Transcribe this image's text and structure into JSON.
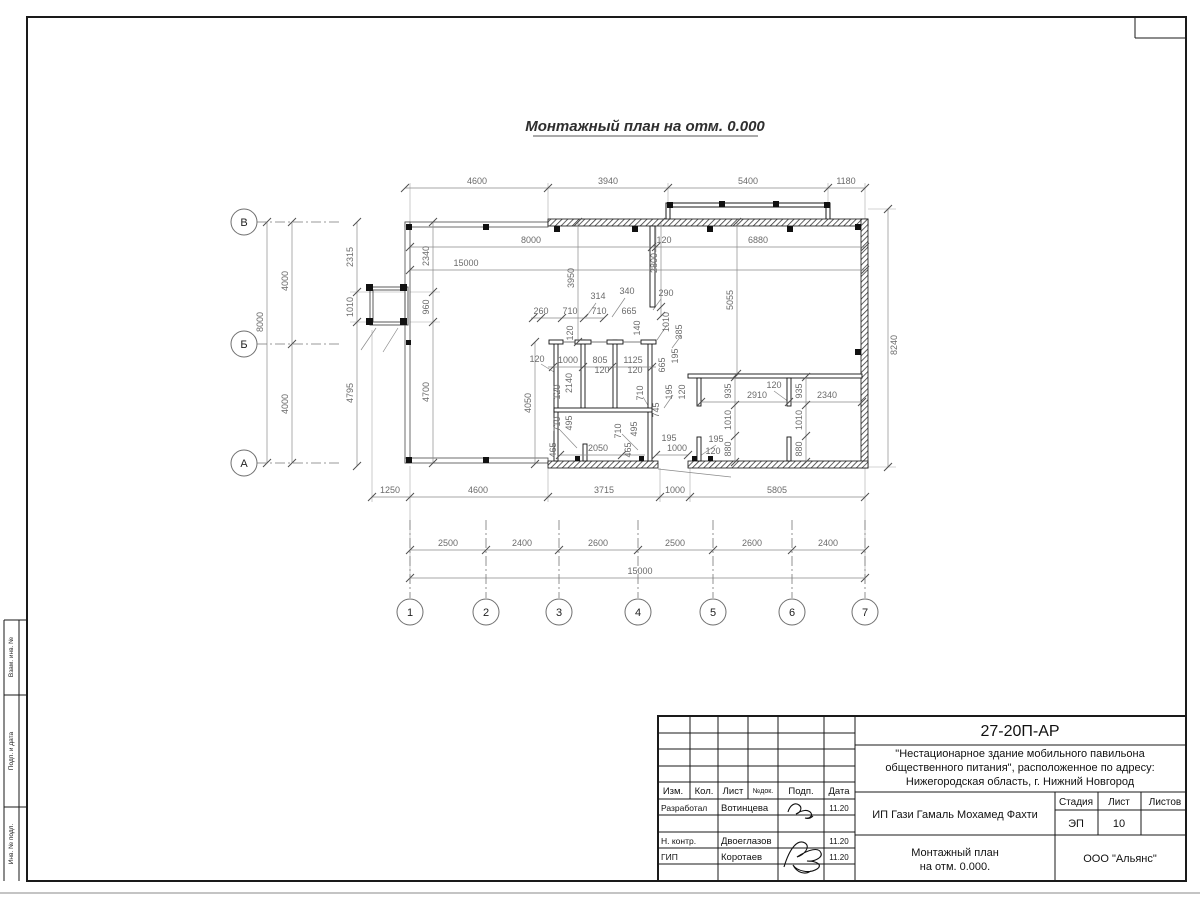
{
  "sheet": {
    "title": "Монтажный план на отм. 0.000"
  },
  "sidebar": {
    "vzam": "Взам. инв. №",
    "podp": "Подп. и дата",
    "inv": "Инв. № подл."
  },
  "titleblock": {
    "code": "27-20П-АР",
    "project_line1": "\"Нестационарное здание мобильного павильона",
    "project_line2": "общественного питания\", расположенное по адресу:",
    "project_line3": "Нижегородская область, г. Нижний Новгород",
    "client": "ИП Гази Гамаль Мохамед Фахти",
    "stage_label": "Стадия",
    "sheet_label": "Лист",
    "sheets_label": "Листов",
    "stage": "ЭП",
    "sheet_no": "10",
    "sheets_no": "",
    "doc_line1": "Монтажный план",
    "doc_line2": "на отм. 0.000.",
    "org": "ООО \"Альянс\"",
    "cols": {
      "izm": "Изм.",
      "kol": "Кол.",
      "list": "Лист",
      "ndok": "№док.",
      "podp": "Подп.",
      "data": "Дата"
    },
    "rows": [
      {
        "role": "Разработал",
        "name": "Вотинцева",
        "date": "11.20"
      },
      {
        "role": "Н. контр.",
        "name": "Двоеглазов",
        "date": "11.20"
      },
      {
        "role": "ГИП",
        "name": "Коротаев",
        "date": "11.20"
      }
    ]
  },
  "plan": {
    "axes": {
      "rows": [
        {
          "label": "В",
          "y": 222
        },
        {
          "label": "Б",
          "y": 344
        },
        {
          "label": "А",
          "y": 463
        }
      ],
      "cols": [
        {
          "label": "1",
          "x": 410
        },
        {
          "label": "2",
          "x": 486
        },
        {
          "label": "3",
          "x": 559
        },
        {
          "label": "4",
          "x": 638
        },
        {
          "label": "5",
          "x": 713
        },
        {
          "label": "6",
          "x": 792
        },
        {
          "label": "7",
          "x": 865
        }
      ]
    },
    "h_chains": [
      {
        "y": 188,
        "x1": 405,
        "x2": 865,
        "ticks": [
          405,
          548,
          668,
          828,
          865
        ],
        "labels": [
          {
            "t": "4600",
            "x": 477
          },
          {
            "t": "3940",
            "x": 608
          },
          {
            "t": "5400",
            "x": 748
          },
          {
            "t": "1180",
            "x": 846
          }
        ]
      },
      {
        "y": 247,
        "x1": 410,
        "x2": 865,
        "ticks": [
          410,
          652,
          656,
          865
        ],
        "labels": [
          {
            "t": "8000",
            "x": 531
          },
          {
            "t": "120",
            "x": 664
          },
          {
            "t": "6880",
            "x": 758
          }
        ]
      },
      {
        "y": 270,
        "x1": 410,
        "x2": 865,
        "ticks": [
          410,
          865
        ],
        "labels": [
          {
            "t": "15000",
            "x": 466
          }
        ]
      },
      {
        "y": 318,
        "x1": 531,
        "x2": 604,
        "ticks": [
          533,
          541,
          562,
          584,
          604
        ],
        "labels": [
          {
            "t": "260",
            "x": 541
          },
          {
            "t": "710",
            "x": 570
          },
          {
            "t": "710",
            "x": 599
          },
          {
            "t": "665",
            "x": 629
          }
        ]
      },
      {
        "y": 367,
        "x1": 548,
        "x2": 656,
        "ticks": [
          553,
          583,
          612,
          652
        ],
        "labels": [
          {
            "t": "1000",
            "x": 568
          },
          {
            "t": "805",
            "x": 600
          },
          {
            "t": "1125",
            "x": 633
          }
        ]
      },
      {
        "y": 402,
        "x1": 701,
        "x2": 862,
        "ticks": [
          701,
          789,
          862
        ],
        "labels": [
          {
            "t": "2910",
            "x": 757
          },
          {
            "t": "2340",
            "x": 827
          }
        ]
      },
      {
        "y": 455,
        "x1": 560,
        "x2": 645,
        "ticks": [
          560,
          622
        ],
        "labels": [
          {
            "t": "2050",
            "x": 598
          }
        ]
      },
      {
        "y": 455,
        "x1": 656,
        "x2": 688,
        "ticks": [
          656,
          688
        ],
        "labels": [
          {
            "t": "1000",
            "x": 677
          }
        ]
      },
      {
        "y": 497,
        "x1": 372,
        "x2": 865,
        "ticks": [
          372,
          410,
          548,
          660,
          690,
          865
        ],
        "labels": [
          {
            "t": "1250",
            "x": 390
          },
          {
            "t": "4600",
            "x": 478
          },
          {
            "t": "3715",
            "x": 604
          },
          {
            "t": "1000",
            "x": 675
          },
          {
            "t": "5805",
            "x": 777
          }
        ]
      },
      {
        "y": 550,
        "x1": 410,
        "x2": 865,
        "ticks": [
          410,
          486,
          559,
          638,
          713,
          792,
          865
        ],
        "labels": [
          {
            "t": "2500",
            "x": 448
          },
          {
            "t": "2400",
            "x": 522
          },
          {
            "t": "2600",
            "x": 598
          },
          {
            "t": "2500",
            "x": 675
          },
          {
            "t": "2600",
            "x": 752
          },
          {
            "t": "2400",
            "x": 828
          }
        ]
      },
      {
        "y": 578,
        "x1": 410,
        "x2": 865,
        "ticks": [
          410,
          865
        ],
        "labels": [
          {
            "t": "15000",
            "x": 640
          }
        ]
      }
    ],
    "v_chains": [
      {
        "x": 267,
        "y1": 222,
        "y2": 463,
        "ticks": [
          222,
          463
        ],
        "labels": [
          {
            "t": "8000",
            "y": 322
          }
        ]
      },
      {
        "x": 292,
        "y1": 222,
        "y2": 463,
        "ticks": [
          222,
          344,
          463
        ],
        "labels": [
          {
            "t": "4000",
            "y": 281
          },
          {
            "t": "4000",
            "y": 404
          }
        ]
      },
      {
        "x": 357,
        "y1": 222,
        "y2": 466,
        "ticks": [
          222,
          292,
          322,
          466
        ],
        "labels": [
          {
            "t": "2315",
            "y": 257
          },
          {
            "t": "1010",
            "y": 307
          },
          {
            "t": "4795",
            "y": 393
          }
        ]
      },
      {
        "x": 433,
        "y1": 222,
        "y2": 463,
        "ticks": [
          222,
          292,
          322,
          463
        ],
        "labels": [
          {
            "t": "2340",
            "y": 256
          },
          {
            "t": "960",
            "y": 307
          },
          {
            "t": "4700",
            "y": 392
          }
        ]
      },
      {
        "x": 888,
        "y1": 209,
        "y2": 467,
        "ticks": [
          209,
          467
        ],
        "labels": [
          {
            "t": "8240",
            "y": 345
          }
        ],
        "side": "right"
      },
      {
        "x": 578,
        "y1": 222,
        "y2": 342,
        "ticks": [
          222,
          342
        ],
        "labels": [
          {
            "t": "3950",
            "y": 278
          }
        ]
      },
      {
        "x": 661,
        "y1": 222,
        "y2": 316,
        "ticks": [
          222,
          307,
          316
        ],
        "labels": [
          {
            "t": "2800",
            "y": 263
          }
        ]
      },
      {
        "x": 737,
        "y1": 222,
        "y2": 374,
        "ticks": [
          222,
          374
        ],
        "labels": [
          {
            "t": "5055",
            "y": 300
          }
        ]
      },
      {
        "x": 535,
        "y1": 342,
        "y2": 464,
        "ticks": [
          342,
          464
        ],
        "labels": [
          {
            "t": "4050",
            "y": 403
          }
        ]
      },
      {
        "x": 735,
        "y1": 377,
        "y2": 462,
        "ticks": [
          377,
          405,
          436,
          462
        ],
        "labels": [
          {
            "t": "935",
            "y": 391
          },
          {
            "t": "1010",
            "y": 420
          },
          {
            "t": "880",
            "y": 449
          }
        ]
      },
      {
        "x": 806,
        "y1": 377,
        "y2": 462,
        "ticks": [
          377,
          405,
          436,
          462
        ],
        "labels": [
          {
            "t": "935",
            "y": 391
          },
          {
            "t": "1010",
            "y": 420
          },
          {
            "t": "880",
            "y": 449
          }
        ]
      }
    ],
    "free_labels": [
      {
        "t": "314",
        "x": 598,
        "y": 299
      },
      {
        "t": "340",
        "x": 627,
        "y": 294
      },
      {
        "t": "290",
        "x": 666,
        "y": 296
      },
      {
        "t": "120",
        "x": 602,
        "y": 373
      },
      {
        "t": "120",
        "x": 635,
        "y": 373
      },
      {
        "t": "120",
        "x": 537,
        "y": 362
      },
      {
        "t": "195",
        "x": 669,
        "y": 441
      },
      {
        "t": "195",
        "x": 716,
        "y": 442
      },
      {
        "t": "120",
        "x": 713,
        "y": 454
      },
      {
        "t": "120",
        "x": 774,
        "y": 388
      },
      {
        "t": "2140",
        "x": 572,
        "y": 383,
        "r": 1
      },
      {
        "t": "120",
        "x": 560,
        "y": 392,
        "r": 1
      },
      {
        "t": "120",
        "x": 573,
        "y": 333,
        "r": 1
      },
      {
        "t": "140",
        "x": 640,
        "y": 328,
        "r": 1
      },
      {
        "t": "1010",
        "x": 669,
        "y": 322,
        "r": 1
      },
      {
        "t": "385",
        "x": 682,
        "y": 332,
        "r": 1
      },
      {
        "t": "665",
        "x": 665,
        "y": 365,
        "r": 1
      },
      {
        "t": "195",
        "x": 678,
        "y": 356,
        "r": 1
      },
      {
        "t": "195",
        "x": 672,
        "y": 392,
        "r": 1
      },
      {
        "t": "120",
        "x": 685,
        "y": 392,
        "r": 1
      },
      {
        "t": "710",
        "x": 643,
        "y": 393,
        "r": 1
      },
      {
        "t": "745",
        "x": 659,
        "y": 410,
        "r": 1
      },
      {
        "t": "710",
        "x": 560,
        "y": 424,
        "r": 1
      },
      {
        "t": "495",
        "x": 572,
        "y": 423,
        "r": 1
      },
      {
        "t": "710",
        "x": 621,
        "y": 431,
        "r": 1
      },
      {
        "t": "495",
        "x": 637,
        "y": 429,
        "r": 1
      },
      {
        "t": "465",
        "x": 556,
        "y": 450,
        "r": 1
      },
      {
        "t": "465",
        "x": 631,
        "y": 450,
        "r": 1
      }
    ]
  }
}
